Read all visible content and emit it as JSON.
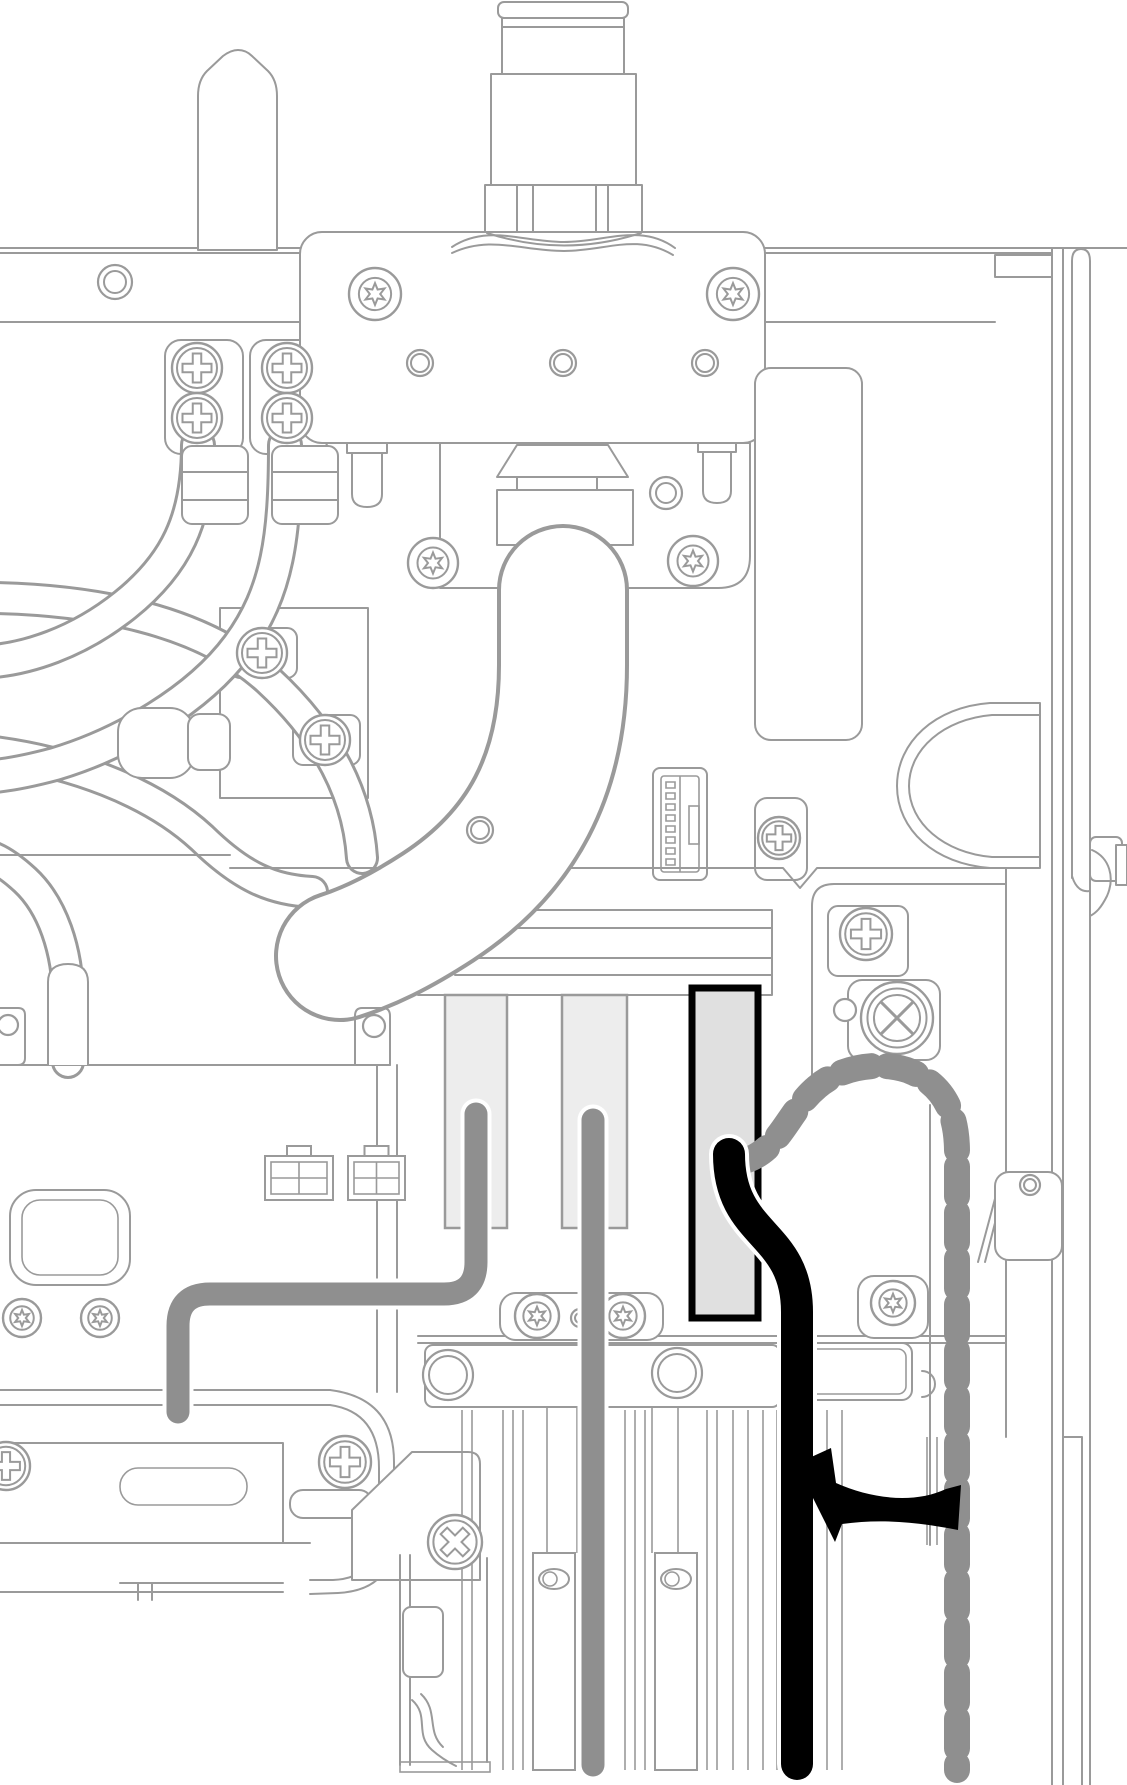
{
  "meta": {
    "type": "hardware-cable-routing-illustration",
    "background": "#ffffff"
  },
  "colors": {
    "line": "#9a9a9a",
    "cable_gray": "#8f8f8f",
    "cable_black": "#000000",
    "slot_fill": "#ededed",
    "highlight_slot_fill": "#e0e0e0",
    "highlight_slot_border": "#000000",
    "white": "#ffffff"
  },
  "cables": [
    {
      "name": "gray-cable-slot1",
      "style": "solid",
      "color": "#8f8f8f",
      "width": 23,
      "halo": 31,
      "path": "M476 1114 L476 1262 Q476 1294 444 1294 L210 1294 Q178 1294 178 1326 L178 1412"
    },
    {
      "name": "gray-cable-slot2",
      "style": "solid",
      "color": "#8f8f8f",
      "width": 23,
      "halo": 31,
      "path": "M593 1120 L593 1765"
    },
    {
      "name": "routing-path-dashed",
      "style": "dashed",
      "color": "#8f8f8f",
      "width": 26,
      "dash": "30 16",
      "path": "M741 1162 C780 1152 787 1112 817 1087 C841 1066 884 1060 912 1072 C947 1087 957 1118 957 1152 L957 1770"
    },
    {
      "name": "black-cable",
      "style": "solid",
      "color": "#000000",
      "width": 32,
      "halo": 40,
      "path": "M729 1154 C729 1238 797 1230 797 1312 L797 1764"
    }
  ],
  "arrow": {
    "name": "rotate-routing-arrow",
    "color": "#000000",
    "path": "M796 1464 L831 1448 L836 1483 C872 1499 914 1504 946 1489 L961 1485 L958 1530 C922 1523 884 1518 842 1524 L835 1542 Z"
  },
  "diagram": {
    "slots": [
      [
        445,
        995,
        62,
        233,
        "#ededed",
        "#9a9a9a",
        2.5,
        "riser-slot-1"
      ],
      [
        562,
        995,
        65,
        233,
        "#ededed",
        "#9a9a9a",
        2.5,
        "riser-slot-2"
      ],
      [
        692,
        988,
        66,
        330,
        "#e0e0e0",
        "#000000",
        7,
        "riser-slot-3-highlighted"
      ]
    ],
    "connectors": [
      [
        265,
        1156,
        68,
        44
      ],
      [
        348,
        1156,
        57,
        44
      ]
    ],
    "screws": [
      [
        "torx",
        375,
        294,
        26
      ],
      [
        "torx",
        733,
        294,
        26
      ],
      [
        "torx",
        433,
        563,
        25
      ],
      [
        "torx",
        693,
        561,
        25
      ],
      [
        "phillips",
        197,
        368,
        25
      ],
      [
        "phillips",
        197,
        418,
        25
      ],
      [
        "phillips",
        287,
        368,
        25
      ],
      [
        "phillips",
        287,
        418,
        25
      ],
      [
        "phillips",
        262,
        653,
        25
      ],
      [
        "phillips",
        325,
        740,
        25
      ],
      [
        "phillips",
        779,
        838,
        21
      ],
      [
        "phillips",
        866,
        934,
        26
      ],
      [
        "bigx",
        897,
        1018,
        36
      ],
      [
        "torx",
        22,
        1318,
        19
      ],
      [
        "torx",
        100,
        1318,
        19
      ],
      [
        "torx",
        537,
        1316,
        22
      ],
      [
        "torx",
        623,
        1316,
        22
      ],
      [
        "torx",
        893,
        1303,
        22
      ],
      [
        "phillips",
        6,
        1466,
        24
      ],
      [
        "phillips",
        345,
        1462,
        26
      ],
      [
        "cross4",
        455,
        1542,
        27
      ]
    ],
    "rings": [
      [
        115,
        282,
        17,
        11
      ],
      [
        420,
        363,
        13,
        9
      ],
      [
        563,
        363,
        13,
        9
      ],
      [
        705,
        363,
        13,
        9
      ],
      [
        666,
        493,
        16,
        10
      ],
      [
        480,
        830,
        13,
        9
      ],
      [
        845,
        1010,
        11,
        0
      ],
      [
        8,
        1025,
        10,
        0
      ],
      [
        374,
        1026,
        11,
        0
      ],
      [
        580,
        1318,
        9,
        5
      ],
      [
        448,
        1375,
        25,
        19
      ],
      [
        677,
        1373,
        25,
        19
      ],
      [
        1030,
        1185,
        10,
        6
      ]
    ],
    "fins": [
      [
        462,
        1410,
        1770
      ],
      [
        472,
        1410,
        1770
      ],
      [
        503,
        1410,
        1770
      ],
      [
        513,
        1410,
        1770
      ],
      [
        523,
        1410,
        1770
      ],
      [
        585,
        1410,
        1770
      ],
      [
        595,
        1410,
        1770
      ],
      [
        605,
        1410,
        1770
      ],
      [
        625,
        1410,
        1770
      ],
      [
        635,
        1410,
        1770
      ],
      [
        645,
        1410,
        1770
      ],
      [
        707,
        1410,
        1770
      ],
      [
        717,
        1410,
        1770
      ],
      [
        733,
        1410,
        1770
      ],
      [
        748,
        1410,
        1770
      ],
      [
        763,
        1410,
        1770
      ],
      [
        777,
        1410,
        1770
      ],
      [
        812,
        1410,
        1770
      ],
      [
        827,
        1410,
        1770
      ],
      [
        842,
        1410,
        1770
      ],
      [
        547,
        1407,
        1553
      ],
      [
        577,
        1407,
        1553
      ],
      [
        652,
        1407,
        1553
      ],
      [
        678,
        1407,
        1553
      ],
      [
        927,
        1437,
        1545
      ],
      [
        937,
        1437,
        1545
      ]
    ],
    "cards": [
      [
        533,
        1553,
        42,
        217,
        1579
      ],
      [
        655,
        1553,
        42,
        217,
        1579
      ]
    ]
  }
}
